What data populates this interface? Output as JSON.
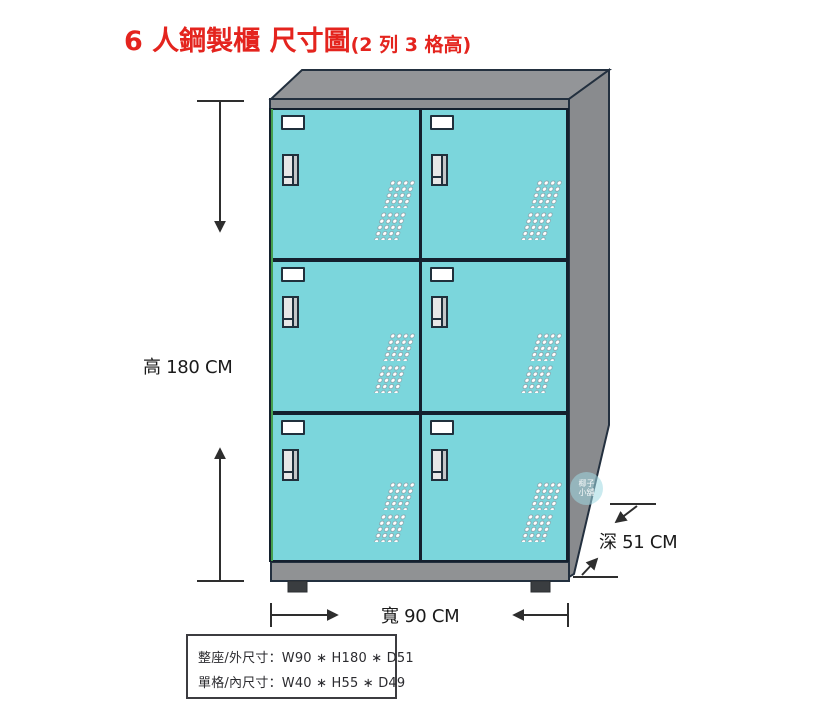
{
  "title": {
    "main": "6 人鋼製櫃 尺寸圖",
    "suffix": "(2 列 3 格高)"
  },
  "dimension_labels": {
    "height": "高 180 CM",
    "width": "寬 90 CM",
    "depth": "深 51 CM"
  },
  "spec_box": {
    "overall_size": "整座/外尺寸：W90 ∗ H180 ∗ D51",
    "cell_size": "單格/內尺寸：W40 ∗ H55 ∗ D49"
  },
  "watermark": {
    "line1": "椰子",
    "line2": "小舖"
  },
  "locker": {
    "rows": 3,
    "columns": 2,
    "compartments": 6,
    "door_color": "#7bd6dc",
    "frame_color": "#909294",
    "outline_color": "#23303f",
    "accent_green_edge": "#45a04e",
    "title_color": "#e4241e"
  }
}
